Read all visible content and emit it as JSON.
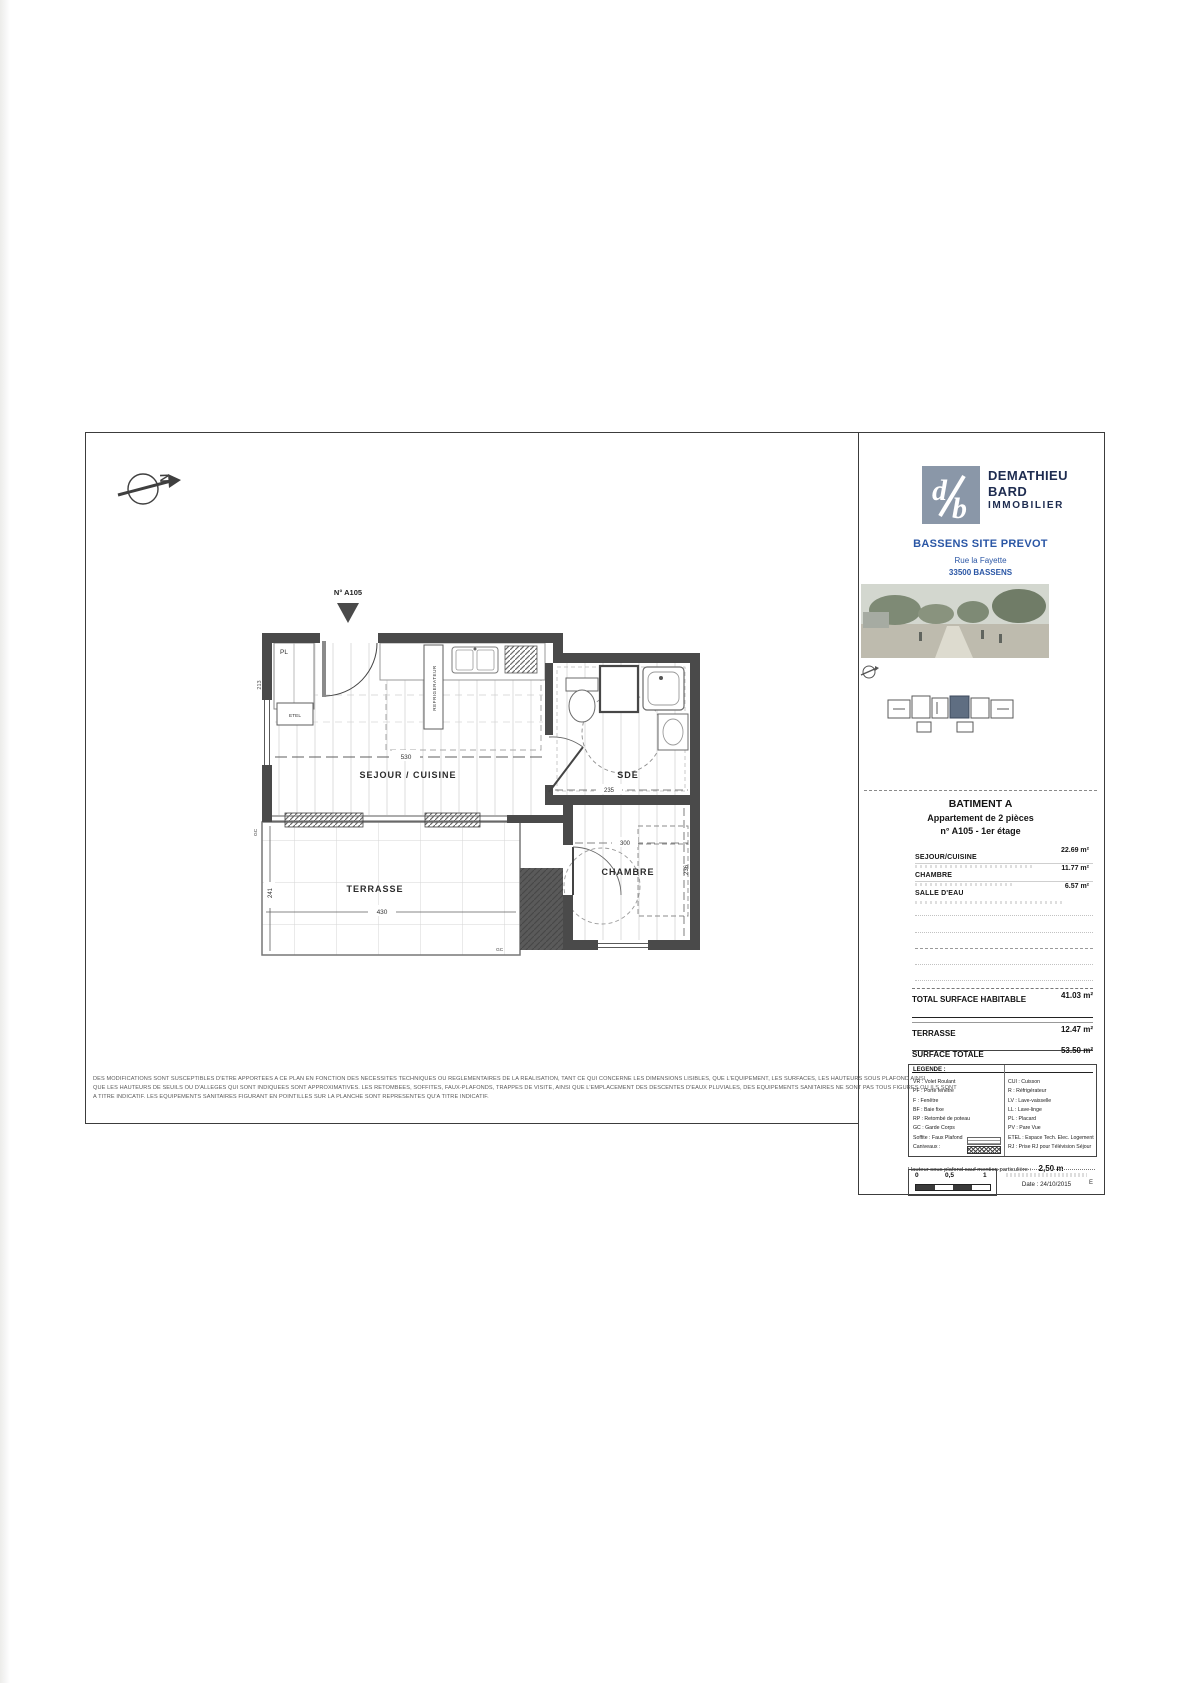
{
  "title_block": {
    "company": {
      "line1": "DEMATHIEU",
      "line2": "BARD",
      "line3": "IMMOBILIER",
      "logo_color": "#8a97a8",
      "text_color": "#1e2c50"
    },
    "project": {
      "name": "BASSENS SITE PREVOT",
      "address1": "Rue la Fayette",
      "address2": "33500 BASSENS",
      "accent_color": "#2a56a5"
    },
    "building": {
      "title": "BATIMENT A",
      "subtitle": "Appartement de 2 pièces",
      "unit": "n° A105 - 1er étage"
    },
    "areas": {
      "rows": [
        {
          "label": "SEJOUR/CUISINE",
          "value": "22.69 m²"
        },
        {
          "label": "CHAMBRE",
          "value": "11.77 m²"
        },
        {
          "label": "SALLE D'EAU",
          "value": "6.57 m²"
        }
      ],
      "total_label": "TOTAL SURFACE HABITABLE",
      "total_value": "41.03 m²",
      "terrace_label": "TERRASSE",
      "terrace_value": "12.47 m²",
      "grand_label": "SURFACE TOTALE",
      "grand_value": "53.50 m²"
    },
    "legend": {
      "title": "LEGENDE :",
      "left": [
        "VR : Volet Roulant",
        "PF : Porte fenêtre",
        "F   : Fenêtre",
        "BF : Baie fixe",
        "RP : Retombé de poteau",
        "GC : Garde Corps",
        "Soffite : Faux Plafond",
        "Caniveaux :"
      ],
      "right": [
        "CUI : Cuisson",
        "R : Réfrigérateur",
        "LV : Lave-vaisselle",
        "LL : Lave-linge",
        "PL : Placard",
        "PV : Pare Vue",
        "ETEL : Espace Tech. Elec. Logement",
        "RJ : Prise RJ pour Télévision Séjour"
      ],
      "ceiling_label": "Hauteur sous plafond sauf mention particulière :",
      "ceiling_value": "2,50 m"
    },
    "scale_ticks": [
      "0",
      "0,5",
      "1"
    ],
    "date_label": "Date : 24/10/2015",
    "revision": "E"
  },
  "plan": {
    "unit_marker": "N° A105",
    "north_letter": "N",
    "rooms": {
      "living": "SEJOUR / CUISINE",
      "bath": "SDE",
      "bedroom": "CHAMBRE",
      "terrace": "TERRASSE"
    },
    "labels": {
      "closet": "PL",
      "etel": "ETEL",
      "fridge": "REFRIGERATEUR",
      "guardrail1": "GC",
      "guardrail2": "GC"
    },
    "dims": {
      "living_width": "530",
      "bath_width": "235",
      "bedroom_width": "300",
      "bedroom_height": "236",
      "terrace_width": "430",
      "terrace_height": "241",
      "left_wall": "213"
    }
  },
  "disclaimer": {
    "line1": "DES MODIFICATIONS SONT SUSCEPTIBLES D'ETRE APPORTEES A CE PLAN EN FONCTION DES NECESSITES TECHNIQUES OU REGLEMENTAIRES DE LA REALISATION, TANT CE QUI CONCERNE LES DIMENSIONS LISIBLES, QUE L'EQUIPEMENT, LES SURFACES, LES HAUTEURS SOUS PLAFOND AINSI",
    "line2": "QUE LES HAUTEURS DE SEUILS OU D'ALLEGES QUI SONT INDIQUEES SONT APPROXIMATIVES. LES RETOMBEES, SOFFITES, FAUX-PLAFONDS, TRAPPES DE VISITE, AINSI QUE L'EMPLACEMENT DES DESCENTES D'EAUX PLUVIALES, DES EQUIPEMENTS SANITAIRES NE SONT PAS TOUS FIGURES OU ILS SONT",
    "line3": "A TITRE INDICATIF. LES EQUIPEMENTS SANITAIRES FIGURANT EN POINTILLES SUR LA PLANCHE SONT REPRESENTES QU'A TITRE INDICATIF."
  }
}
